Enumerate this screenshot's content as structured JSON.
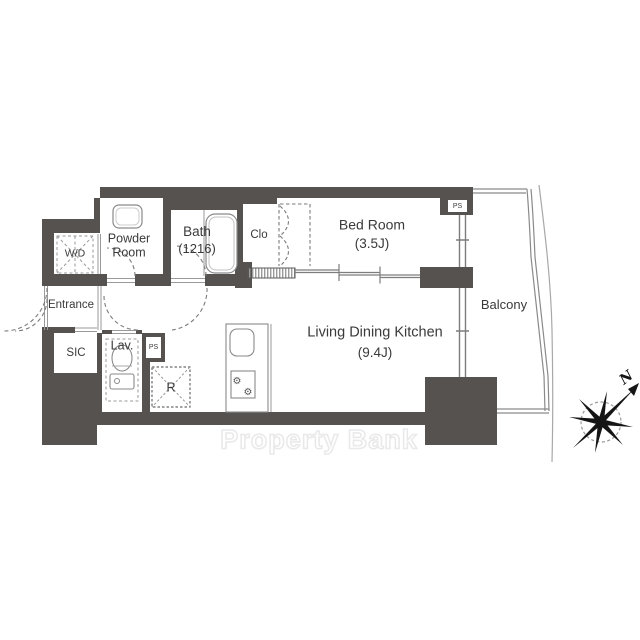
{
  "plan": {
    "rooms": {
      "wd": "W/D",
      "powder_line1": "Powder",
      "powder_line2": "Room",
      "bath": "Bath",
      "bath_size": "(1216)",
      "closet": "Clo",
      "bedroom": "Bed Room",
      "bedroom_size": "(3.5J)",
      "entrance": "Entrance",
      "sic": "SIC",
      "lavatory": "Lav.",
      "fridge": "R",
      "ldk": "Living Dining Kitchen",
      "ldk_size": "(9.4J)",
      "balcony": "Balcony",
      "ps_top": "PS",
      "ps_lav": "PS"
    },
    "compass": {
      "north_label": "N"
    },
    "watermark": "Property Bank",
    "icons": {
      "burner_glyph": "⚙"
    },
    "colors": {
      "wall": "#56524f",
      "thin_line": "#858585",
      "dashed_line": "#7a7a7a",
      "text": "#3a3a3a",
      "watermark_outline": "#e9e9e9"
    }
  }
}
